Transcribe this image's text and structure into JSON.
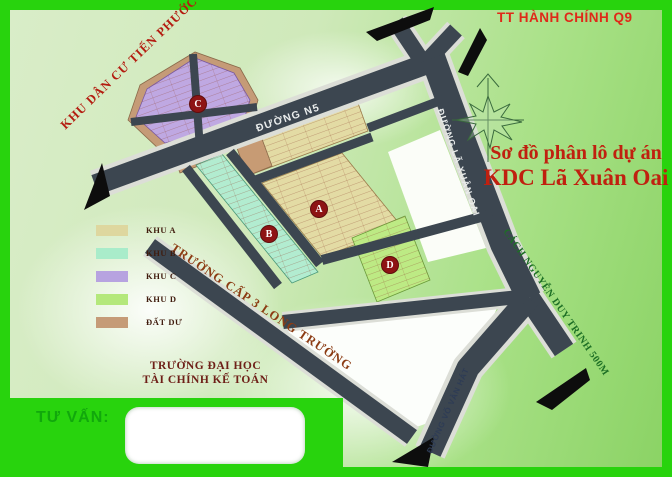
{
  "header": {
    "district_label": "TT HÀNH CHÍNH Q9"
  },
  "title": {
    "line1": "Sơ đồ phân lô dự án",
    "line2": "KDC Lã Xuân Oai"
  },
  "map": {
    "neighbor_area": "KHU DÂN CƯ TIẾN PHƯỚC",
    "roads": [
      {
        "name": "ĐƯỜNG N5"
      },
      {
        "name": "ĐƯỜNG LÃ XUÂN OAI"
      },
      {
        "name": "ĐƯỜNG VÕ VĂN HÁT"
      }
    ],
    "notes": [
      {
        "text": "TRƯỜNG CẤP 3 LONG TRƯỜNG"
      },
      {
        "text": "CÁCH NGUYỄN DUY TRINH 500M"
      }
    ],
    "university": {
      "line1": "TRƯỜNG ĐẠI HỌC",
      "line2": "TÀI CHÍNH KẾ TOÁN"
    },
    "zones": [
      {
        "id": "A",
        "label": "A"
      },
      {
        "id": "B",
        "label": "B"
      },
      {
        "id": "C",
        "label": "C"
      },
      {
        "id": "D",
        "label": "D"
      }
    ]
  },
  "legend": {
    "items": [
      {
        "label": "KHU A",
        "color": "#ded79f"
      },
      {
        "label": "KHU B",
        "color": "#a9ecca"
      },
      {
        "label": "KHU C",
        "color": "#b7a3e0"
      },
      {
        "label": "KHU D",
        "color": "#b4e87b"
      },
      {
        "label": "ĐẤT DƯ",
        "color": "#c59b77"
      }
    ]
  },
  "footer": {
    "consultant_label": "TƯ VẤN:"
  },
  "colors": {
    "frame_green": "#28d30d",
    "road_dark": "#3c4650",
    "road_casing": "#dcded7",
    "title_red": "#c0200f",
    "zone_badge": "#8e1414"
  }
}
